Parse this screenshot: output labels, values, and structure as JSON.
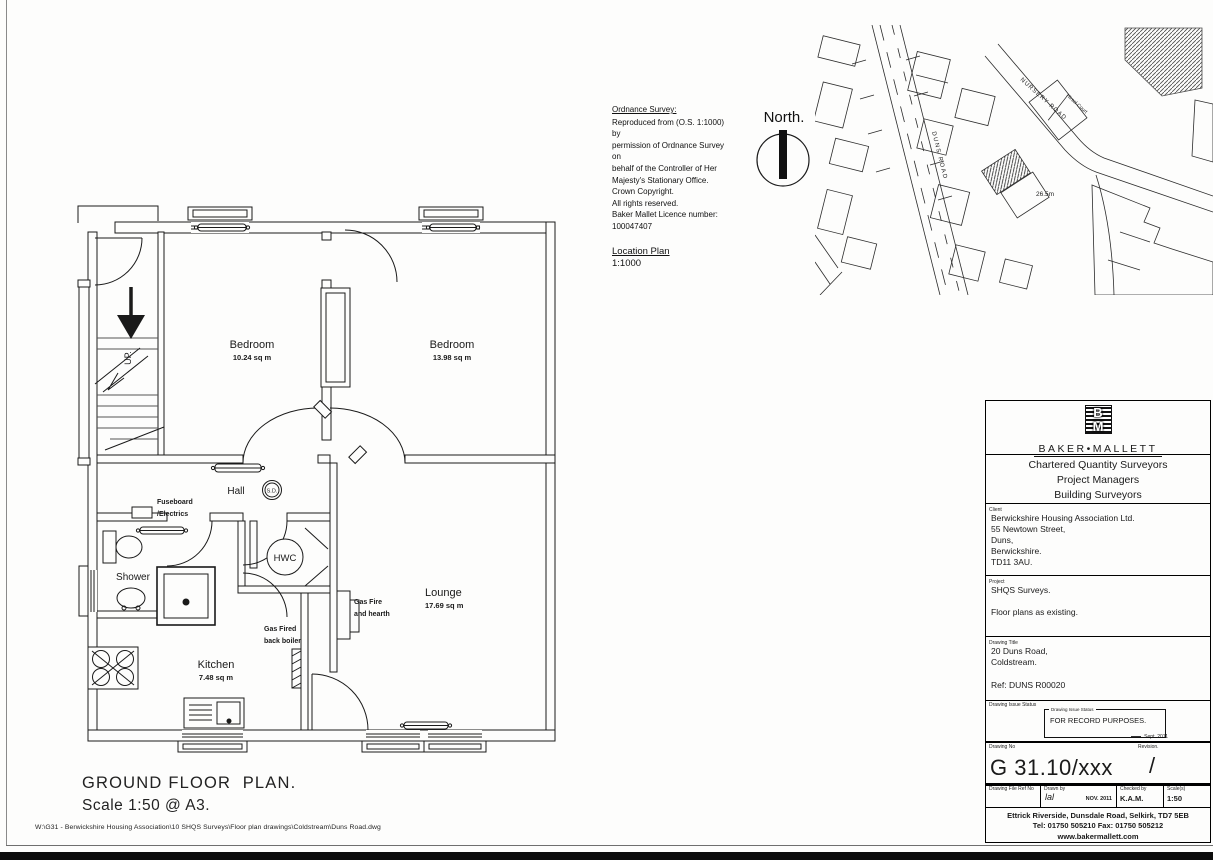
{
  "ordnance_survey": {
    "title": "Ordnance Survey:",
    "lines": [
      "Reproduced from (O.S. 1:1000) by",
      "permission of Ordnance Survey on",
      "behalf of the Controller of Her",
      "Majesty's Stationary Office.",
      "Crown Copyright.",
      "All rights reserved.",
      "Baker Mallet Licence number:",
      "100047407"
    ]
  },
  "north": {
    "label": "North."
  },
  "location_plan": {
    "title": "Location Plan",
    "scale": "1:1000"
  },
  "map": {
    "road_duns": "DUNS ROAD",
    "road_nursery": "NURSERY ROAD",
    "hirsel_court": "Hirsel Court",
    "spot_height": "26.5m"
  },
  "floor_plan": {
    "bedroom1_name": "Bedroom",
    "bedroom1_area": "10.24 sq m",
    "bedroom2_name": "Bedroom",
    "bedroom2_area": "13.98 sq m",
    "hall_label": "Hall",
    "smoke_detector": "S.D.",
    "up_label": "UP.",
    "fuseboard_line1": "Fuseboard",
    "fuseboard_line2": "/Electrics",
    "shower_label": "Shower",
    "hwc_label": "HWC",
    "kitchen_name": "Kitchen",
    "kitchen_area": "7.48 sq m",
    "lounge_name": "Lounge",
    "lounge_area": "17.69 sq m",
    "gas_fire_line1": "Gas Fire",
    "gas_fire_line2": "and hearth",
    "boiler_line1": "Gas Fired",
    "boiler_line2": "back boiler"
  },
  "caption": {
    "title": "GROUND FLOOR  PLAN.",
    "scale": "Scale 1:50 @ A3."
  },
  "title_block": {
    "logo_b": "B",
    "logo_m": "M",
    "company": "BAKER•MALLETT",
    "tagline": [
      "Chartered Quantity Surveyors",
      "Project Managers",
      "Building Surveyors"
    ],
    "client_label": "Client",
    "client": [
      "Berwickshire Housing Association Ltd.",
      "55 Newtown Street,",
      "Duns,",
      "Berwickshire.",
      "TD11 3AU."
    ],
    "project_label": "Project",
    "project_line1": "SHQS Surveys.",
    "project_line2": "Floor plans as existing.",
    "drawing_title_label": "Drawing Title",
    "drawing_title_line1": "20 Duns Road,",
    "drawing_title_line2": "Coldstream.",
    "drawing_title_ref": "Ref: DUNS R00020",
    "issue_status_label": "Drawing Issue Status",
    "issue_box_label": "Drawing Issue Status",
    "issue_status": "FOR RECORD PURPOSES.",
    "issue_date": "Sept. 2011",
    "drawing_no_label": "Drawing No",
    "drawing_no": "G 31.10/xxx",
    "revision_label": "Revision.",
    "revision": "/",
    "file_ref_label": "Drawing File Ref No",
    "drawn_by_label": "Drawn by",
    "drawn_by": "lal",
    "drawn_date": "NOV. 2011",
    "checked_by_label": "Checked by",
    "checked_by": "K.A.M.",
    "scales_label": "Scale(s)",
    "scales": "1:50",
    "address": "Ettrick Riverside, Dunsdale Road, Selkirk, TD7 5EB",
    "phone": "Tel:  01750 505210    Fax:  01750 505212",
    "website": "www.bakermallett.com"
  },
  "footer": {
    "file_path": "W:\\G31 - Berwickshire Housing Association\\10 SHQS Surveys\\Floor plan drawings\\Coldstream\\Duns Road.dwg"
  }
}
